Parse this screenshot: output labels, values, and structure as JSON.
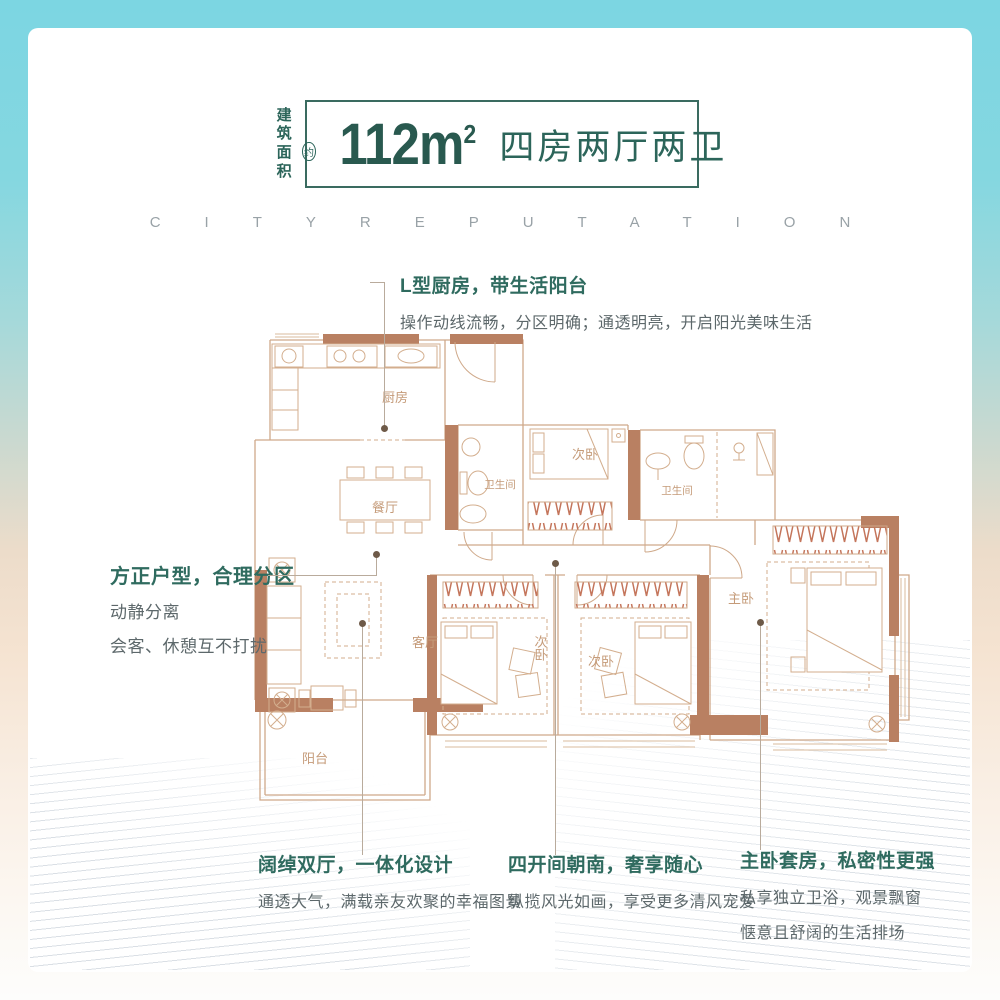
{
  "header": {
    "area_label_line1": "建筑",
    "area_label_line2": "面积",
    "approx_mark": "约",
    "area_value": "112",
    "area_unit": "m",
    "area_sup": "2",
    "layout_text": "四房两厅两卫"
  },
  "watermark": "CITYREPUTATION",
  "callouts": {
    "top": {
      "title": "L型厨房，带生活阳台",
      "desc": "操作动线流畅，分区明确；通透明亮，开启阳光美味生活"
    },
    "left": {
      "title": "方正户型，合理分区",
      "line1": "动静分离",
      "line2": "会客、休憩互不打扰"
    },
    "bottom": [
      {
        "title": "阔绰双厅，一体化设计",
        "line1": "通透大气，满载亲友欢聚的幸福图景"
      },
      {
        "title": "四开间朝南，奢享随心",
        "line1": "纵揽风光如画，享受更多清风宠爱"
      },
      {
        "title": "主卧套房，私密性更强",
        "line1": "私享独立卫浴，观景飘窗",
        "line2": "惬意且舒阔的生活排场"
      }
    ]
  },
  "floorplan": {
    "rooms": {
      "kitchen": "厨房",
      "dining": "餐厅",
      "bath_main": "卫生间",
      "bath_master": "卫生间",
      "bedroom_top": "次卧",
      "bedroom_mid_left": "次卧",
      "bedroom_mid_right": "次卧",
      "master": "主卧",
      "living": "客厅",
      "balcony": "阳台"
    }
  },
  "colors": {
    "frame_teal": "#7cd6e2",
    "frame_peach": "#f5e3d1",
    "accent_teal": "#2f6b5f",
    "body_gray": "#5d686b",
    "wall_brown": "#b98062",
    "plan_line": "#cfa98a",
    "plan_label": "#c59b79",
    "wardrobe_hatch": "#c4755b",
    "watermark_gray": "#99a2a7"
  }
}
